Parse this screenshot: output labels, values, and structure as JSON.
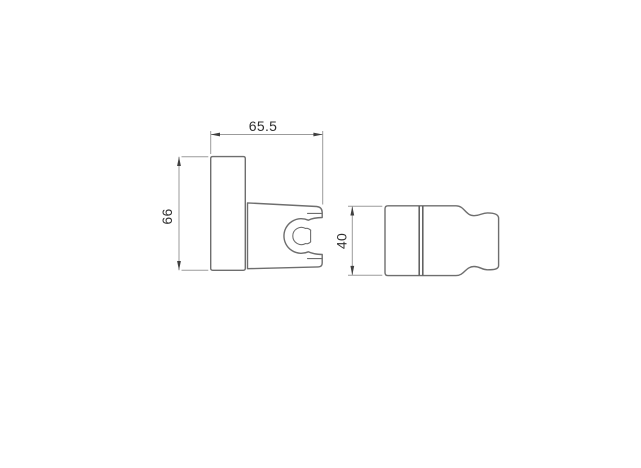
{
  "drawing": {
    "title": "shower-holder-technical-drawing",
    "views": {
      "front": {
        "name": "front view",
        "parts": [
          "wall plate",
          "holder body",
          "c-shaped clamp cradle"
        ]
      },
      "side": {
        "name": "side view",
        "parts": [
          "wall plate",
          "holder body profile"
        ]
      }
    },
    "dimensions": {
      "width_label": "65.5",
      "height_label": "66",
      "depth_label": "40"
    },
    "colors": {
      "background": "#ffffff",
      "part_line": "#6e6e6e",
      "part_line_dark": "#5a5a5a",
      "dimension_line": "#9b9b9b",
      "arrow": "#3f3f3f",
      "text": "#2f2f2f"
    }
  }
}
